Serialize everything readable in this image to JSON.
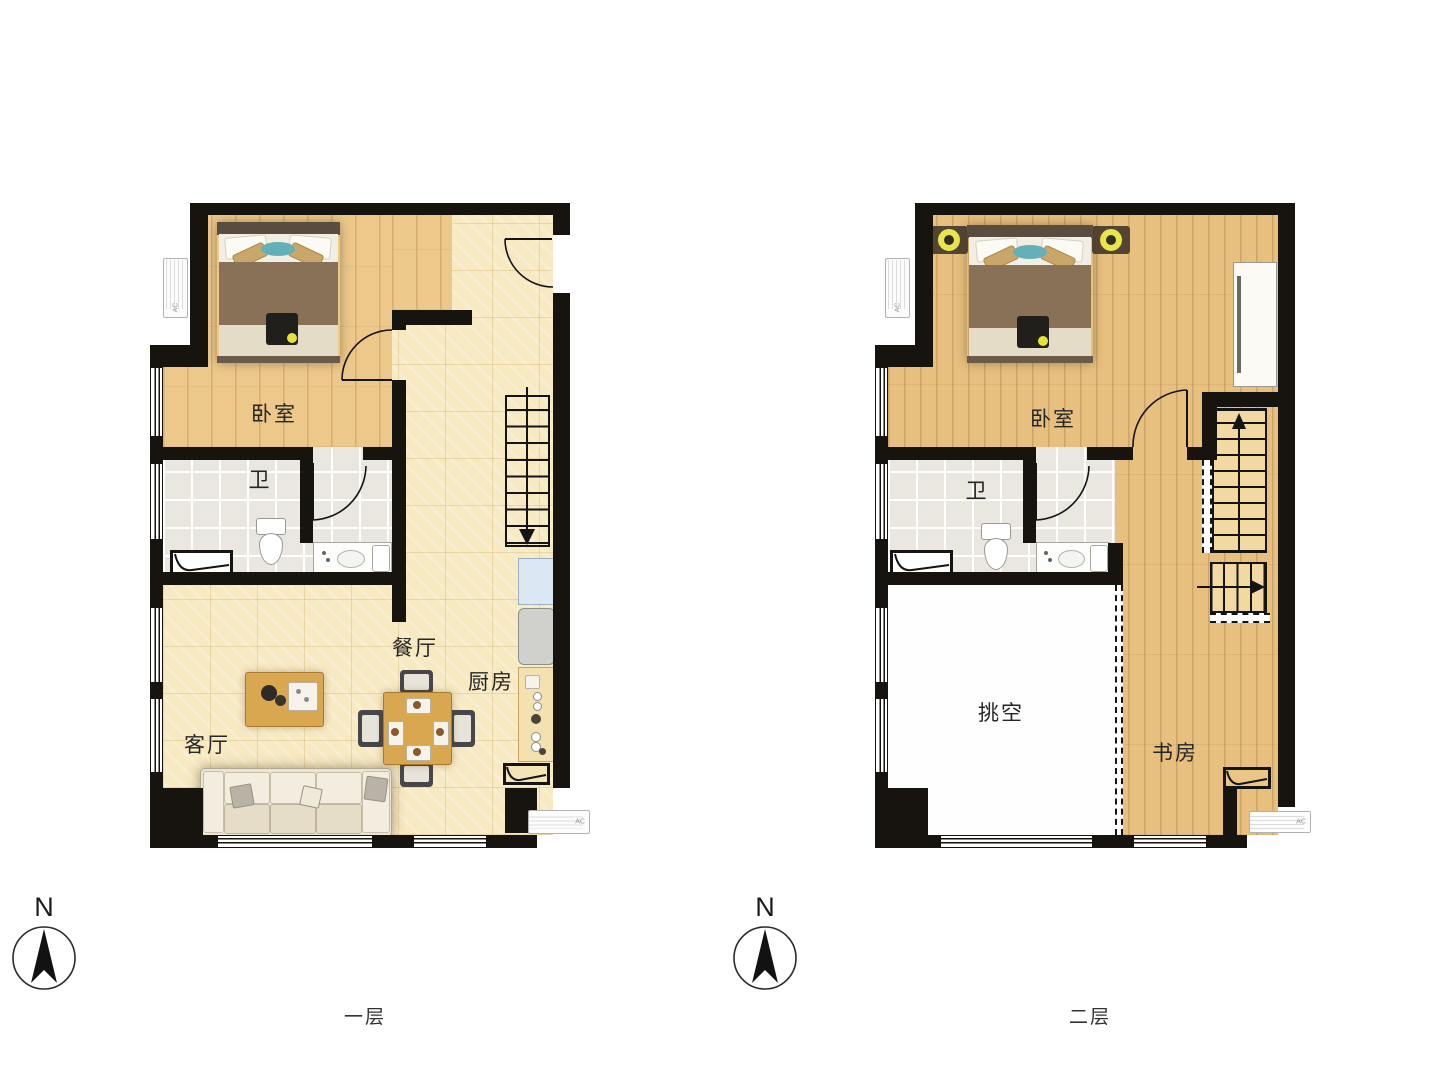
{
  "ac_label": "AC",
  "compass": {
    "letter": "N"
  },
  "floors": [
    {
      "label": "一层",
      "rooms": {
        "bedroom": "卧室",
        "bath": "卫",
        "living": "客厅",
        "dining": "餐厅",
        "kitchen": "厨房"
      }
    },
    {
      "label": "二层",
      "rooms": {
        "bedroom": "卧室",
        "bath": "卫",
        "void": "挑空",
        "study": "书房"
      }
    }
  ],
  "colors": {
    "wall": "#17130e",
    "tile_floor": "#f7e9c2",
    "wood_floor_1": "#ecc88b",
    "wood_floor_2": "#e7c07f",
    "bath_tile": "#eae7e0",
    "stair_wood": "#f1d9a1",
    "lamp_yellow": "#e8e64a",
    "teal_pillow": "#64b0b9",
    "fridge_blue": "#dbe7f3"
  }
}
